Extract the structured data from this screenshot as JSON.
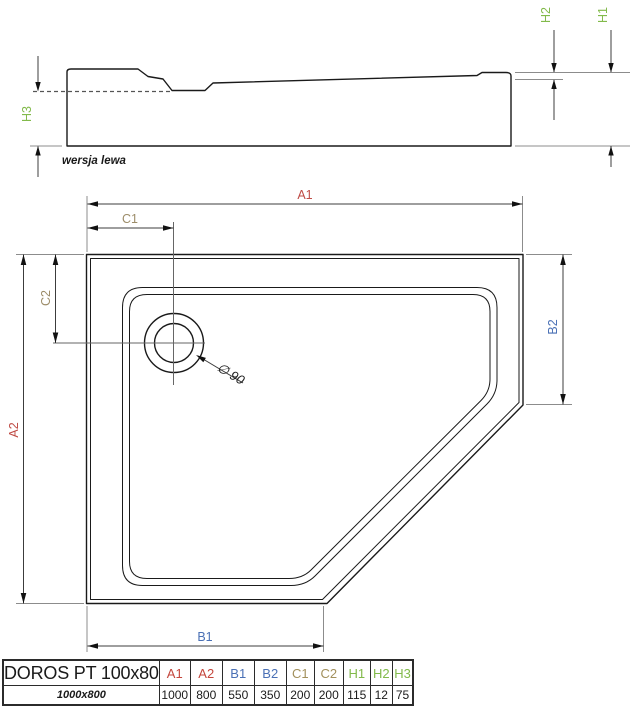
{
  "side_view": {
    "caption": "wersja lewa",
    "dim_labels": {
      "h1": "H1",
      "h2": "H2",
      "h3": "H3"
    }
  },
  "top_view": {
    "dim_labels": {
      "a1": "A1",
      "a2": "A2",
      "b1": "B1",
      "b2": "B2",
      "c1": "C1",
      "c2": "C2"
    },
    "drain_diameter_label": "∅ 90"
  },
  "colors": {
    "dim_a_red": "#bf4b45",
    "dim_b_blue": "#4a70b5",
    "dim_c_tan": "#9d8d6a",
    "dim_h_green": "#82ba4b",
    "line_black": "#1a1a1a"
  },
  "table": {
    "product_name": "DOROS PT 100x80",
    "size_label": "1000x800",
    "columns": [
      {
        "label": "A1",
        "value": "1000"
      },
      {
        "label": "A2",
        "value": "800"
      },
      {
        "label": "B1",
        "value": "550"
      },
      {
        "label": "B2",
        "value": "350"
      },
      {
        "label": "C1",
        "value": "200"
      },
      {
        "label": "C2",
        "value": "200"
      },
      {
        "label": "H1",
        "value": "115"
      },
      {
        "label": "H2",
        "value": "12"
      },
      {
        "label": "H3",
        "value": "75"
      }
    ]
  }
}
